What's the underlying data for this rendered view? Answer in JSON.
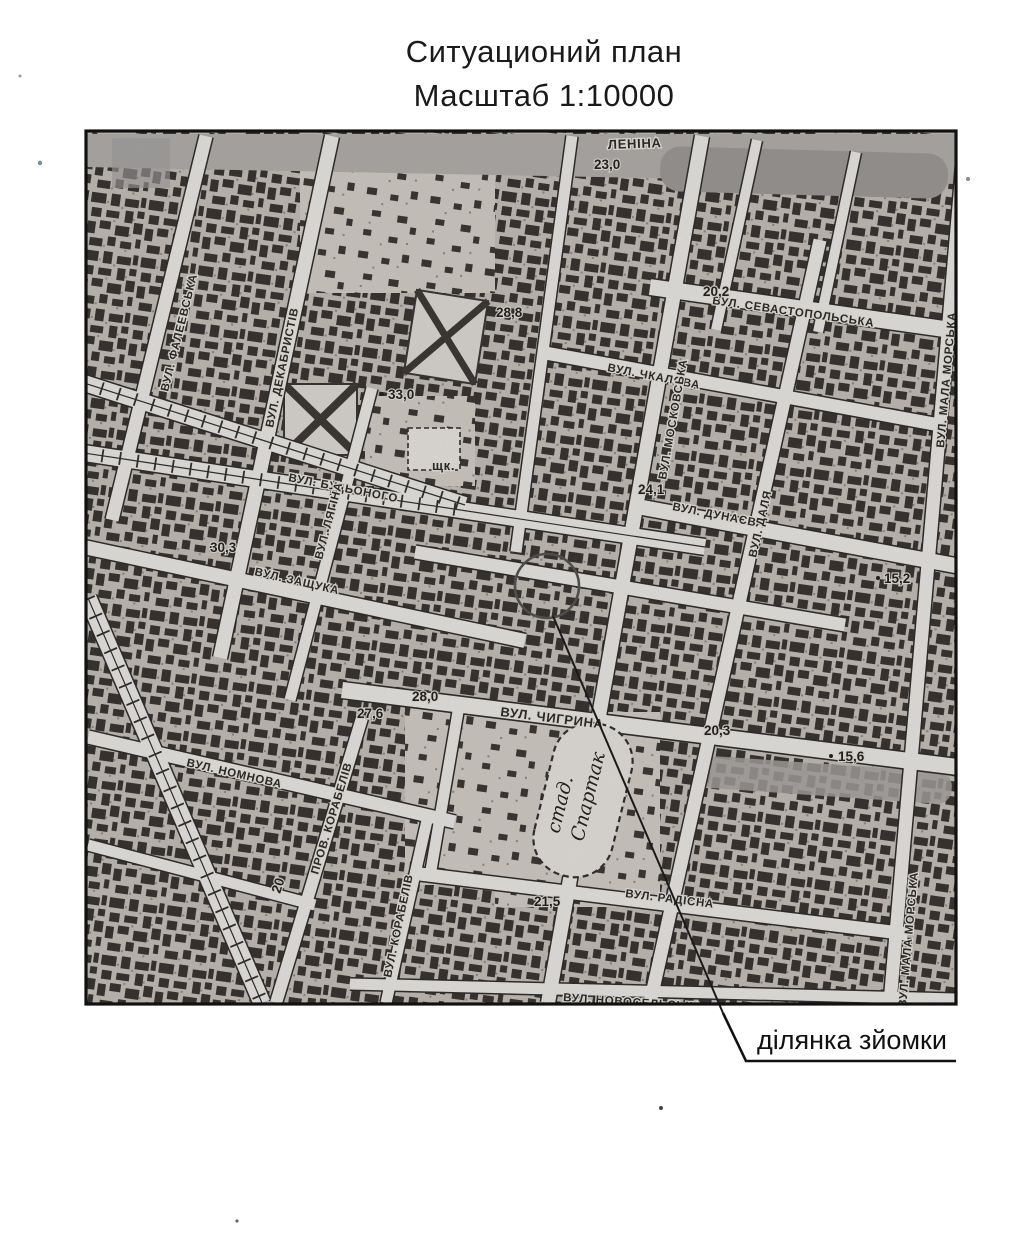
{
  "page": {
    "title_line1": "Ситуационий план",
    "title_line2": "Масштаб 1:10000"
  },
  "map": {
    "streets": [
      {
        "text": "ЛЕНІНА"
      },
      {
        "text": "ВУЛ. СЕВАСТОПОЛЬСЬКА"
      },
      {
        "text": "ВУЛ. ЧКАЛОВА"
      },
      {
        "text": "ВУЛ. МАЛА МОРСЬКА"
      },
      {
        "text": "ВУЛ. ФАЛЕЕВСЬКА"
      },
      {
        "text": "ВУЛ. ДЕКАБРИСТІВ"
      },
      {
        "text": "ВУЛ. БУДЬОНОГО"
      },
      {
        "text": "ВУЛ. МОСКОВСЬКА"
      },
      {
        "text": "ВУЛ. ДУНАЄВА"
      },
      {
        "text": "ВУЛ. ДАЛЯ"
      },
      {
        "text": "ВУЛ. ЛЯГІНА"
      },
      {
        "text": "ВУЛ. ЗАЩУКА"
      },
      {
        "text": "щк."
      },
      {
        "text": "ВУЛ. ЧИГРИНА"
      },
      {
        "text": "ВУЛ. НОМНОВА"
      },
      {
        "text": "ПРОВ. КОРАБЕЛІВ"
      },
      {
        "text": "ВУЛ. КОРАБЕЛІВ"
      },
      {
        "text": "ВУЛ. РАДІСНА"
      },
      {
        "text": "ВУЛ. НОВОСЕЛЬСЬКА"
      },
      {
        "text": "ВУЛ. МАЛА МОРСЬКА"
      }
    ],
    "elevations": [
      {
        "text": "23,0"
      },
      {
        "text": "20,2"
      },
      {
        "text": "28,8"
      },
      {
        "text": "33,0"
      },
      {
        "text": "24,1"
      },
      {
        "text": "30,3"
      },
      {
        "text": "15,2"
      },
      {
        "text": "28,0"
      },
      {
        "text": "27,6"
      },
      {
        "text": "20,3"
      },
      {
        "text": "15,6"
      },
      {
        "text": "21,5"
      },
      {
        "text": "20"
      }
    ],
    "stadium": {
      "line1": "стад.",
      "line2": "Спартак"
    },
    "callout": {
      "label": "ділянка зйомки"
    },
    "colors": {
      "ink": "#1b1b1b",
      "paper": "#ffffff",
      "street": "#f5f3ef",
      "boulevard_gray": "#b0aeac"
    }
  }
}
